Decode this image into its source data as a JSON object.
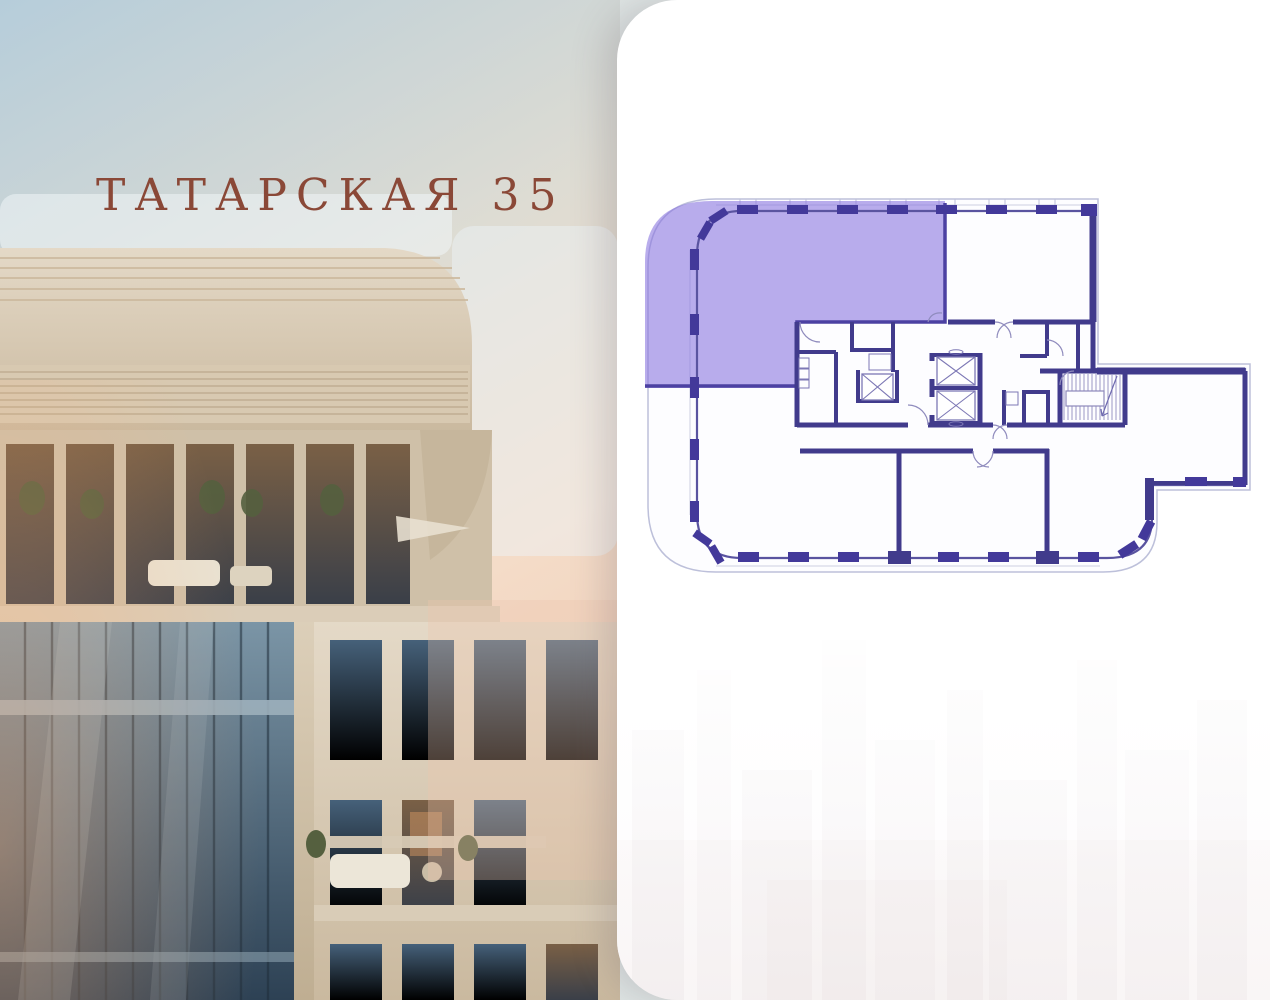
{
  "brand": {
    "logo_text": "ТАТАРСКАЯ 35",
    "logo_color": "#8a4837"
  },
  "floor_plan": {
    "name": "floor-plan",
    "highlight_color": "#8a76e0",
    "wall_color": "#413b8c",
    "outline_color": "#bdc0da"
  },
  "stats": {
    "items": [
      {
        "value": "3",
        "label": "КОРПУС"
      },
      {
        "value": "2",
        "label": "СЕКЦИЯ"
      },
      {
        "value": "12",
        "label": "ЭТАЖ"
      }
    ],
    "value_color": "#4b4195",
    "label_color": "#201e1f",
    "divider_color": "#564ba5"
  }
}
